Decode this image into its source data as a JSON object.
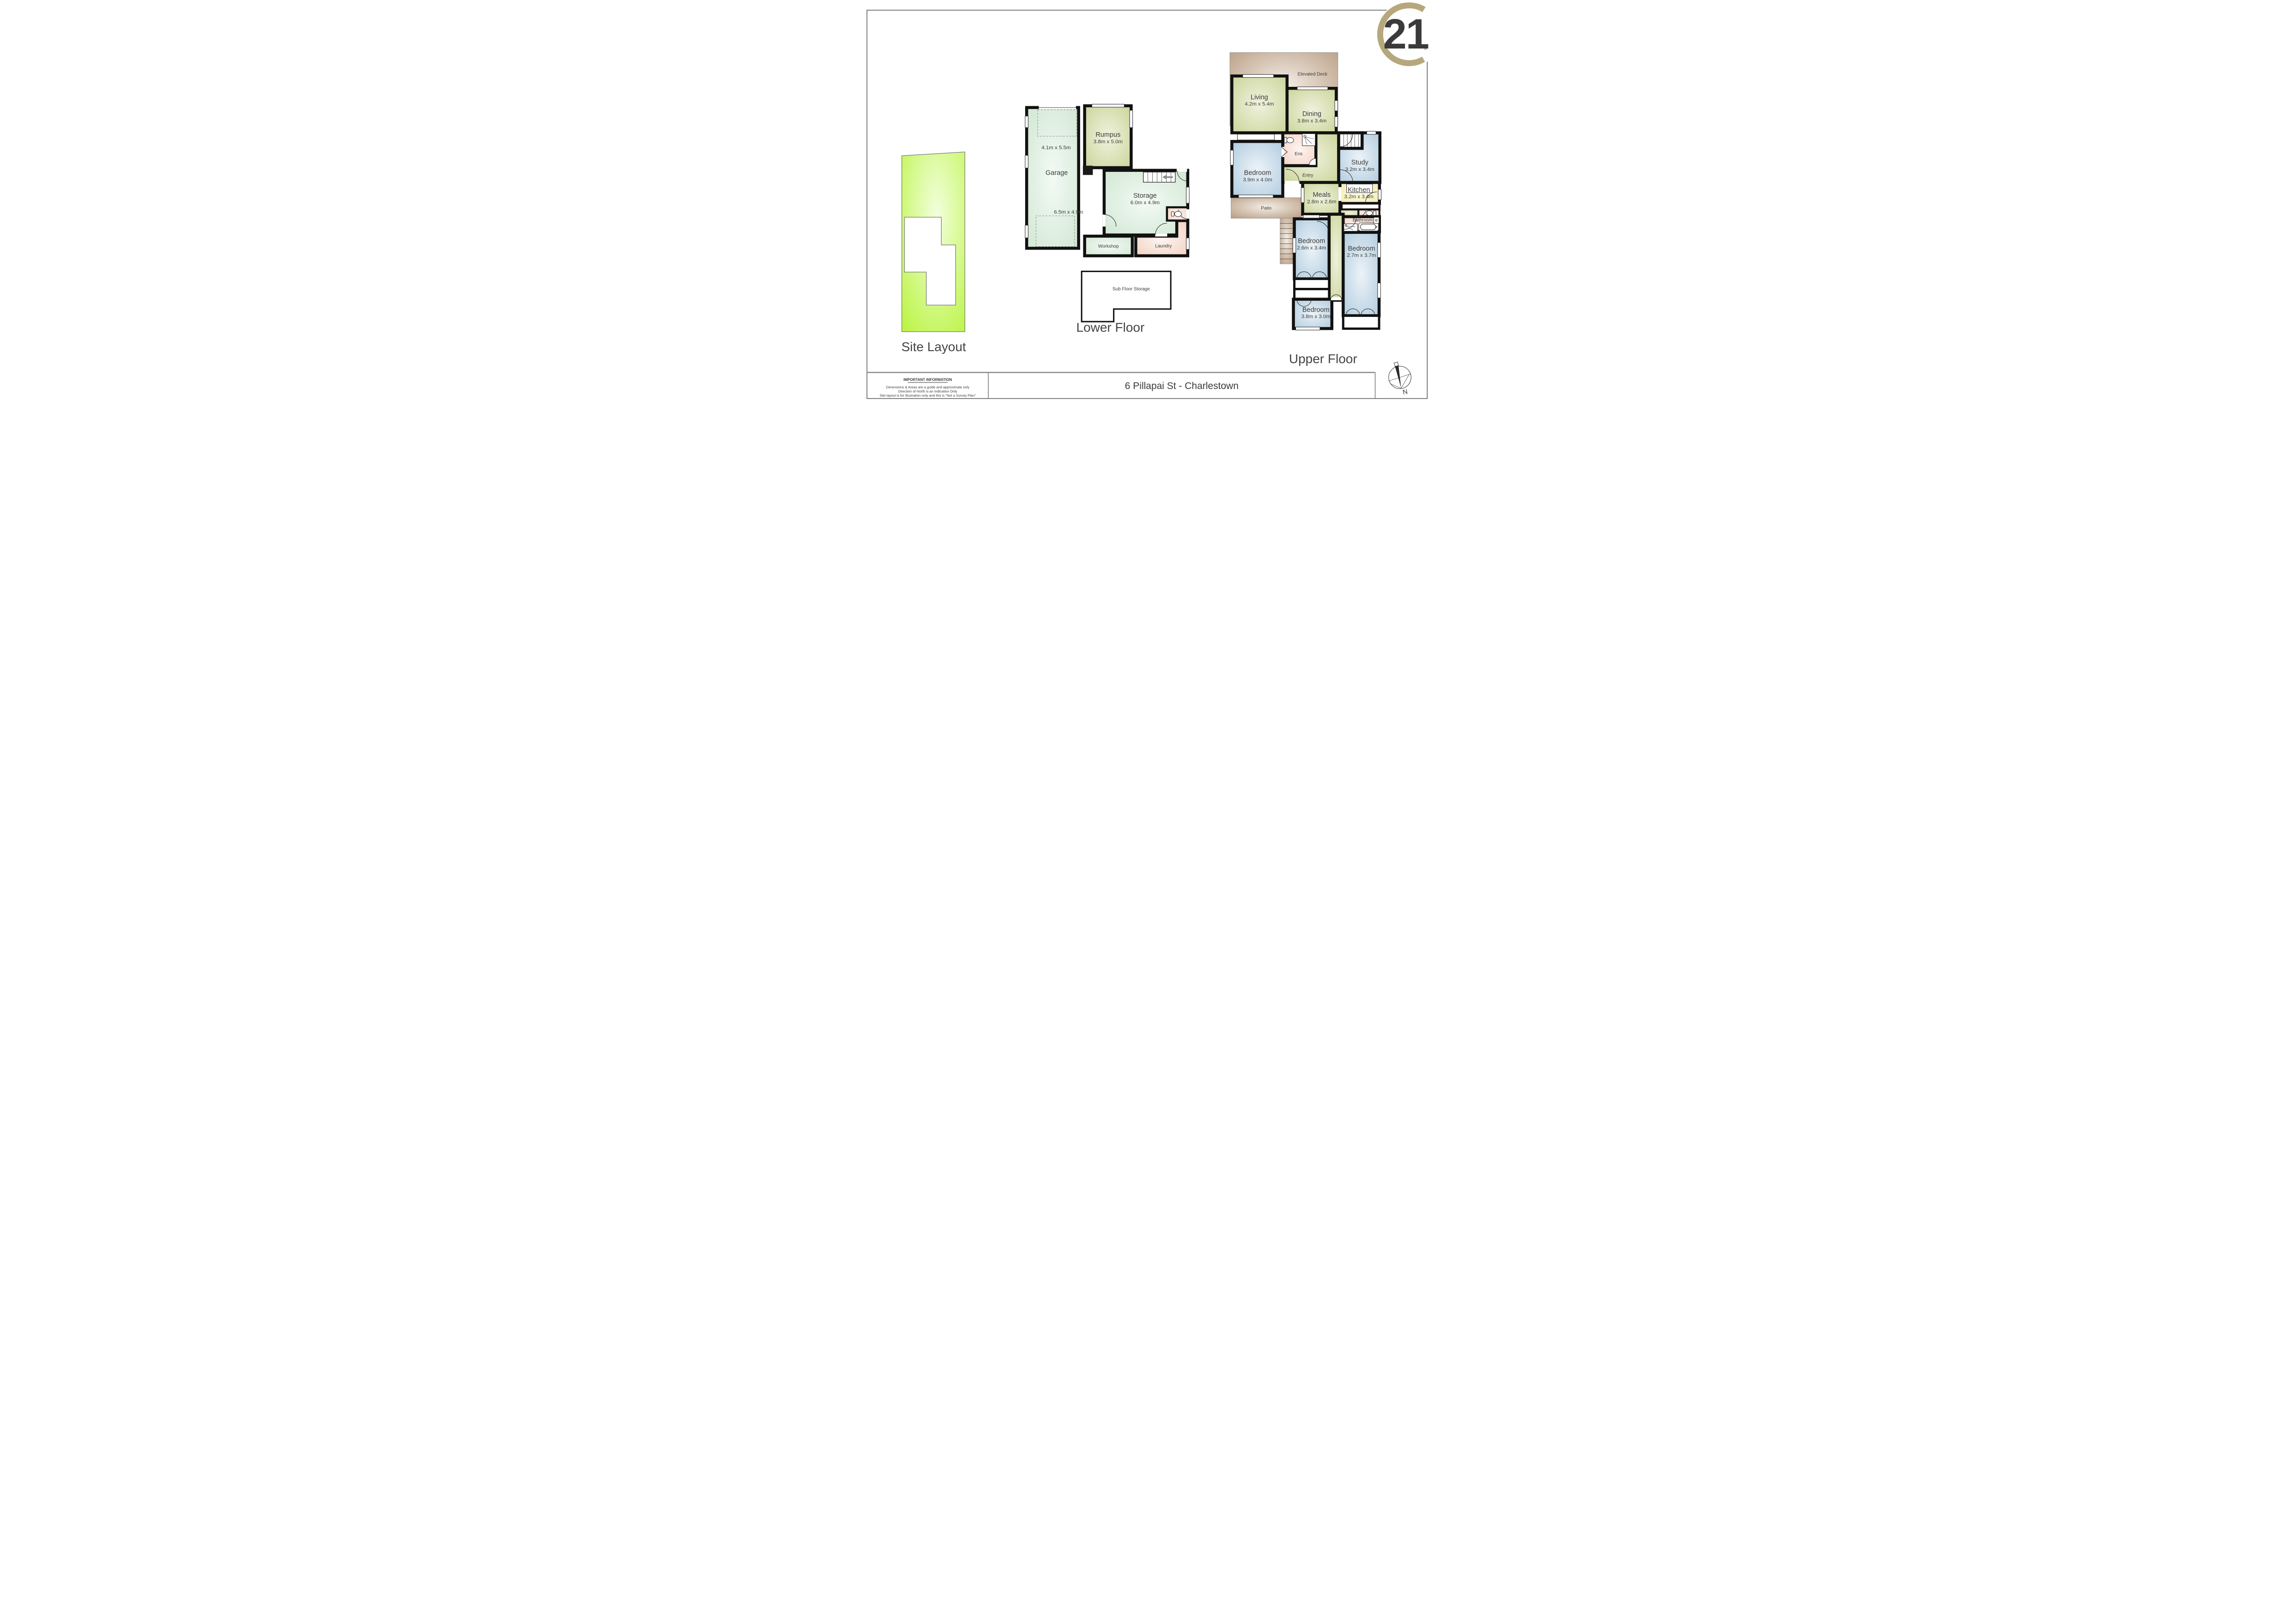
{
  "page": {
    "background": "#ffffff",
    "border_color": "#555555"
  },
  "logo": {
    "number": "21",
    "registered_mark": "®",
    "color": "#b6a87d"
  },
  "site_layout": {
    "title": "Site Layout",
    "land_color": "#bdf449"
  },
  "lower_floor": {
    "title": "Lower Floor",
    "rooms": {
      "garage": {
        "name": "Garage",
        "dims_top": "4.1m x 5.5m",
        "dims_bottom": "6.5m x 4.9m"
      },
      "rumpus": {
        "name": "Rumpus",
        "dims": "3.8m x 5.0m"
      },
      "storage": {
        "name": "Storage",
        "dims": "6.0m x 4.9m"
      },
      "workshop": {
        "name": "Workshop"
      },
      "laundry": {
        "name": "Laundry"
      },
      "sub_floor_storage": {
        "name": "Sub Floor Storage"
      }
    }
  },
  "upper_floor": {
    "title": "Upper Floor",
    "rooms": {
      "elevated_deck": {
        "name": "Elevated Deck"
      },
      "living": {
        "name": "Living",
        "dims": "4.2m x 5.4m"
      },
      "dining": {
        "name": "Dining",
        "dims": "3.8m x 3.4m"
      },
      "bedroom_main": {
        "name": "Bedroom",
        "dims": "3.9m x 4.0m"
      },
      "ensuite": {
        "name": "Ens"
      },
      "entry": {
        "name": "Entry"
      },
      "study": {
        "name": "Study",
        "dims": "3.2m x 3.4m"
      },
      "meals": {
        "name": "Meals",
        "dims": "2.8m x 2.6m"
      },
      "kitchen": {
        "name": "Kitchen",
        "dims": "3.2m x 3.4m"
      },
      "patio": {
        "name": "Patio"
      },
      "bedroom_two": {
        "name": "Bedroom",
        "dims": "2.6m x 3.4m"
      },
      "bathroom": {
        "name": "Bathroom"
      },
      "bedroom_three": {
        "name": "Bedroom",
        "dims": "2.7m x 3.7m"
      },
      "bedroom_four": {
        "name": "Bedroom",
        "dims": "3.8m x 3.0m"
      }
    }
  },
  "footer": {
    "heading": "IMPORTANT INFORMATION",
    "line1": "Dimensions & Areas are a guide and approximate only",
    "line2": "Direction of North is an Indication Only",
    "line3": "Site layout is for illustration only and this is “Not a Survey Plan”",
    "address": "6 Pillapai St - Charlestown",
    "compass_label": "N"
  },
  "colors": {
    "wall": "#111111",
    "room_green": "#cfe6d2",
    "room_olive": "#c8d296",
    "room_blue": "#adc9dd",
    "room_pink": "#f2cfc0",
    "room_yellow": "#f2e9a8",
    "deck_brown": "#b29478",
    "site_green": "#bdf449"
  }
}
